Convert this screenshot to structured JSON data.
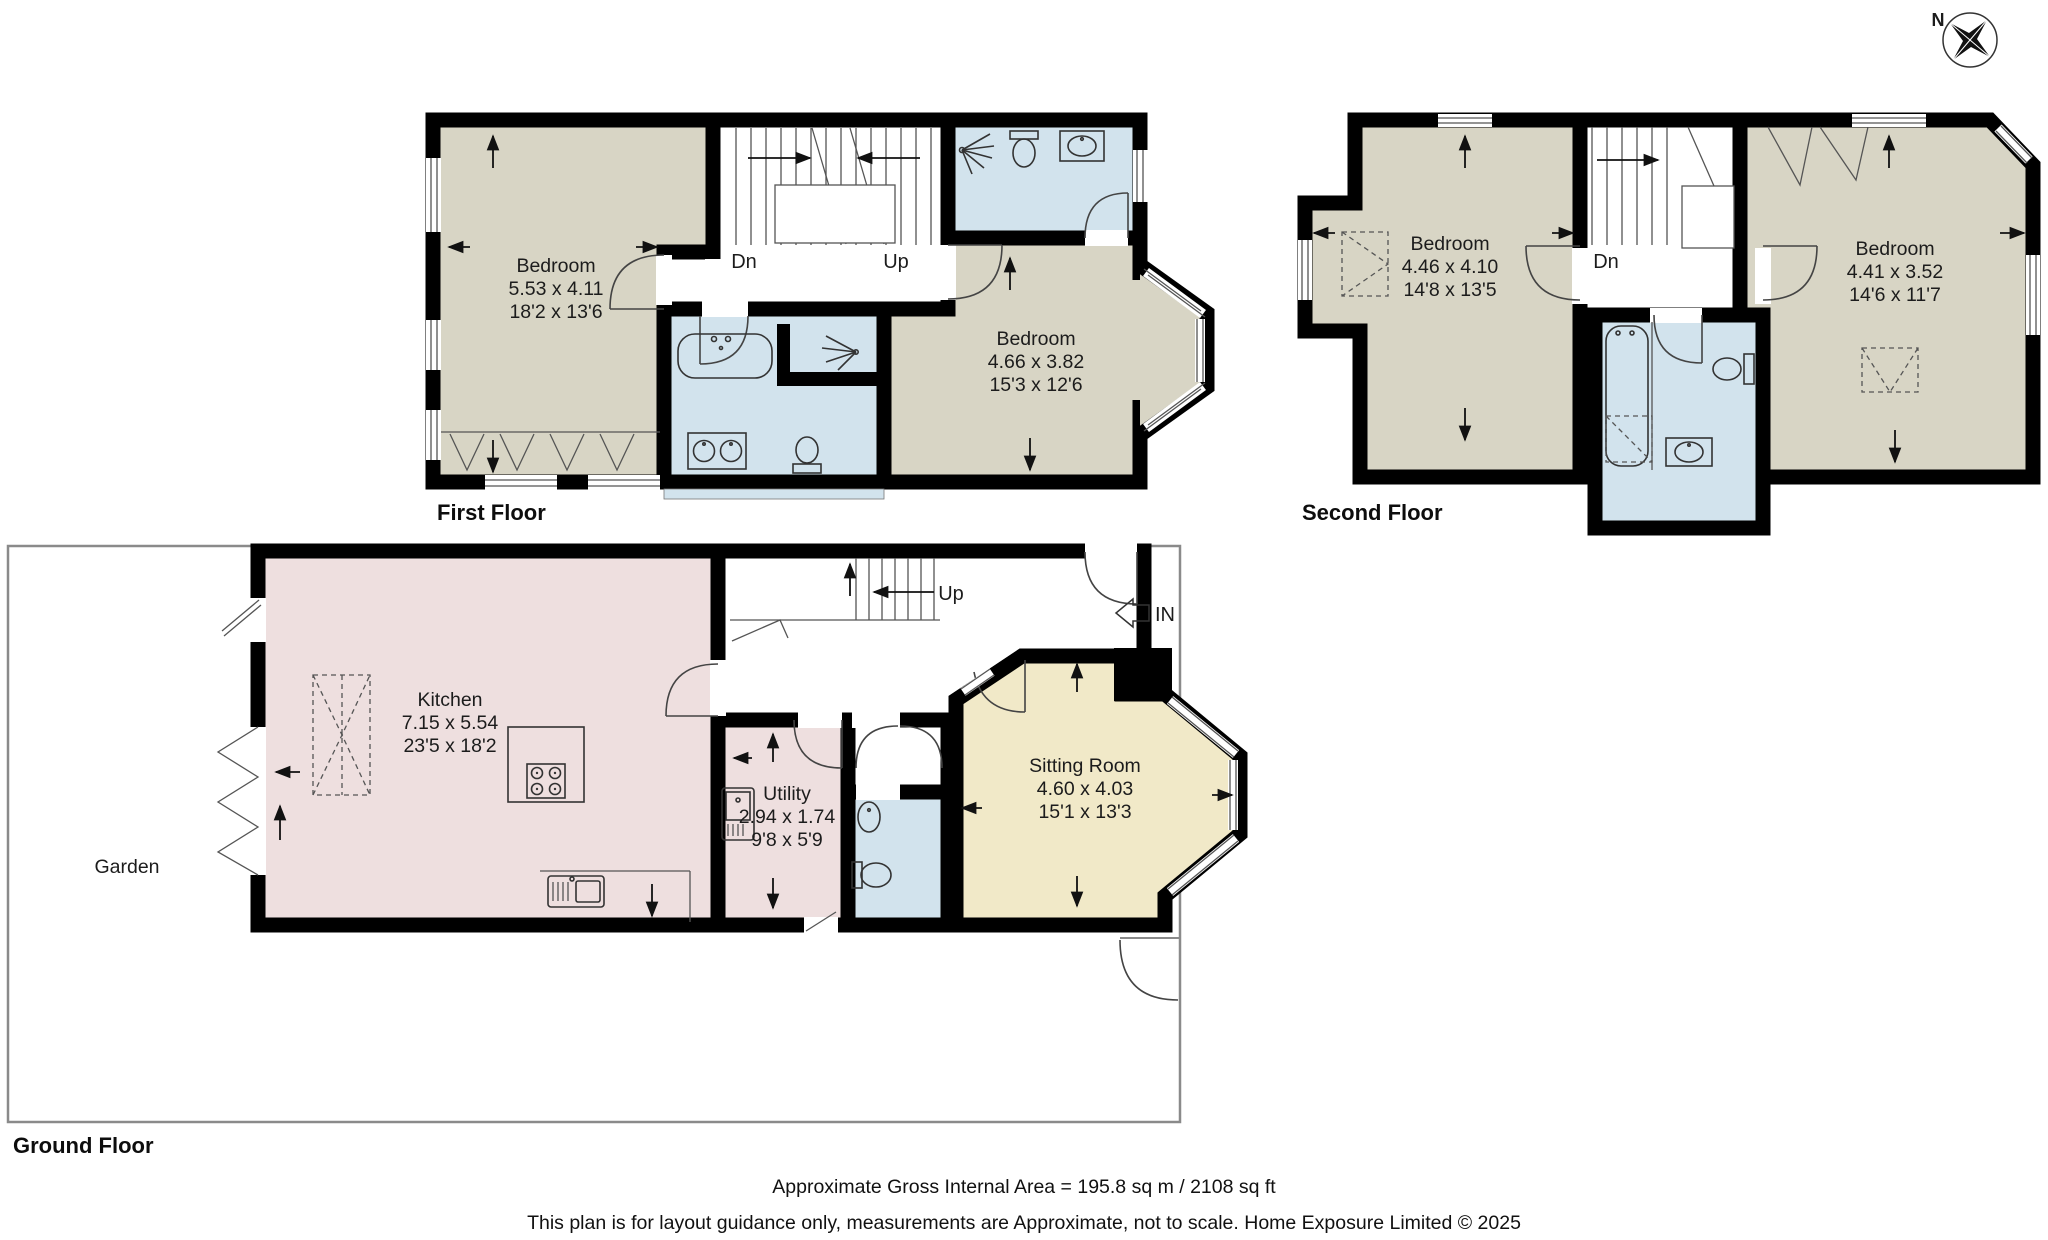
{
  "compass": {
    "north_label": "N"
  },
  "floors": {
    "first": {
      "title": "First Floor",
      "stairs": {
        "down": "Dn",
        "up": "Up"
      },
      "rooms": {
        "bedroom_left": {
          "name": "Bedroom",
          "metric": "5.53 x 4.11",
          "imperial": "18'2 x 13'6"
        },
        "bedroom_right": {
          "name": "Bedroom",
          "metric": "4.66 x 3.82",
          "imperial": "15'3 x 12'6"
        }
      }
    },
    "second": {
      "title": "Second Floor",
      "stairs": {
        "down": "Dn"
      },
      "rooms": {
        "bedroom_left": {
          "name": "Bedroom",
          "metric": "4.46 x 4.10",
          "imperial": "14'8 x 13'5"
        },
        "bedroom_right": {
          "name": "Bedroom",
          "metric": "4.41 x 3.52",
          "imperial": "14'6 x 11'7"
        }
      }
    },
    "ground": {
      "title": "Ground Floor",
      "stairs": {
        "up": "Up"
      },
      "entrance_label": "IN",
      "garden_label": "Garden",
      "rooms": {
        "kitchen": {
          "name": "Kitchen",
          "metric": "7.15 x 5.54",
          "imperial": "23'5 x 18'2"
        },
        "utility": {
          "name": "Utility",
          "metric": "2.94 x 1.74",
          "imperial": "9'8 x 5'9"
        },
        "sitting_room": {
          "name": "Sitting Room",
          "metric": "4.60 x 4.03",
          "imperial": "15'1 x 13'3"
        }
      }
    }
  },
  "footer": {
    "area_text": "Approximate Gross Internal Area = 195.8 sq m / 2108 sq ft",
    "disclaimer": "This plan is for layout guidance only, measurements are Approximate, not to scale. Home Exposure Limited © 2025"
  },
  "colors": {
    "bedroom_fill": "#d8d5c5",
    "bathroom_fill": "#d2e3ed",
    "kitchen_fill": "#eedfdf",
    "sitting_room_fill": "#f1e9c8",
    "wall": "#000000",
    "garden_outline": "#8a8a8a"
  }
}
